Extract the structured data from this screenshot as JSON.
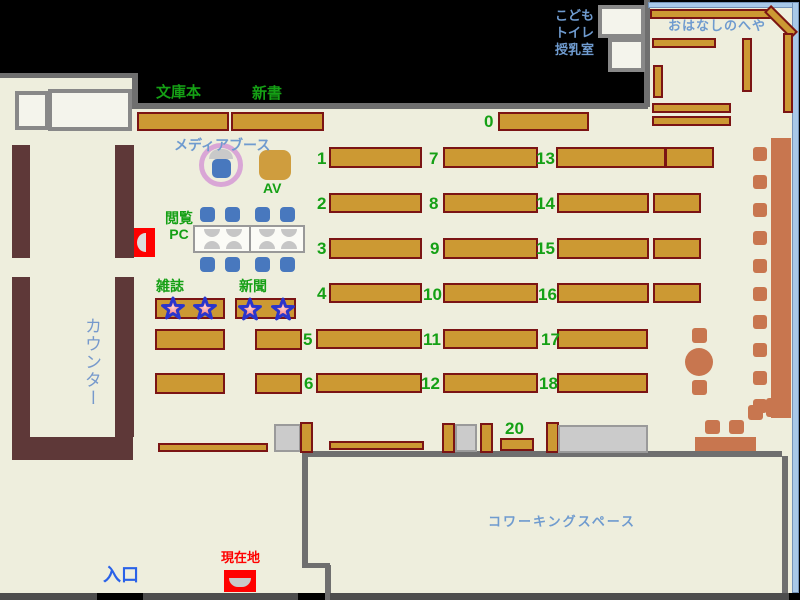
{
  "areas": {
    "bunko": "文庫本",
    "shinsho": "新書",
    "media_booth": "メディアブース",
    "av": "AV",
    "pc_line1": "閲覧",
    "pc_line2": "PC",
    "magazines": "雑誌",
    "newspapers": "新聞",
    "counter": "カウンター",
    "entrance": "入口",
    "current_location": "現在地",
    "kids": "こども",
    "toilet": "トイレ",
    "nursing": "授乳室",
    "story_room": "おはなしのへや",
    "coworking": "コワーキングスペース"
  },
  "nums": {
    "0": "0",
    "1": "1",
    "2": "2",
    "3": "3",
    "4": "4",
    "5": "5",
    "6": "6",
    "7": "7",
    "8": "8",
    "9": "9",
    "10": "10",
    "11": "11",
    "12": "12",
    "13": "13",
    "14": "14",
    "15": "15",
    "16": "16",
    "17": "17",
    "18": "18",
    "20": "20"
  },
  "colors": {
    "floor": "#eeeedd",
    "wall": "#6f6f6f",
    "shelf": "#cc9933",
    "shelf_border": "#7b1414",
    "counter": "#5e3838",
    "terracotta": "#c8764f",
    "chair_blue": "#4878be",
    "label_green": "#15a015",
    "label_blue": "#6f9bcf",
    "entrance_blue": "#2a62e8",
    "marker_red": "#ff0000",
    "booth_ring": "#d9a6d6",
    "room_border_blue": "#a8c8e8"
  }
}
